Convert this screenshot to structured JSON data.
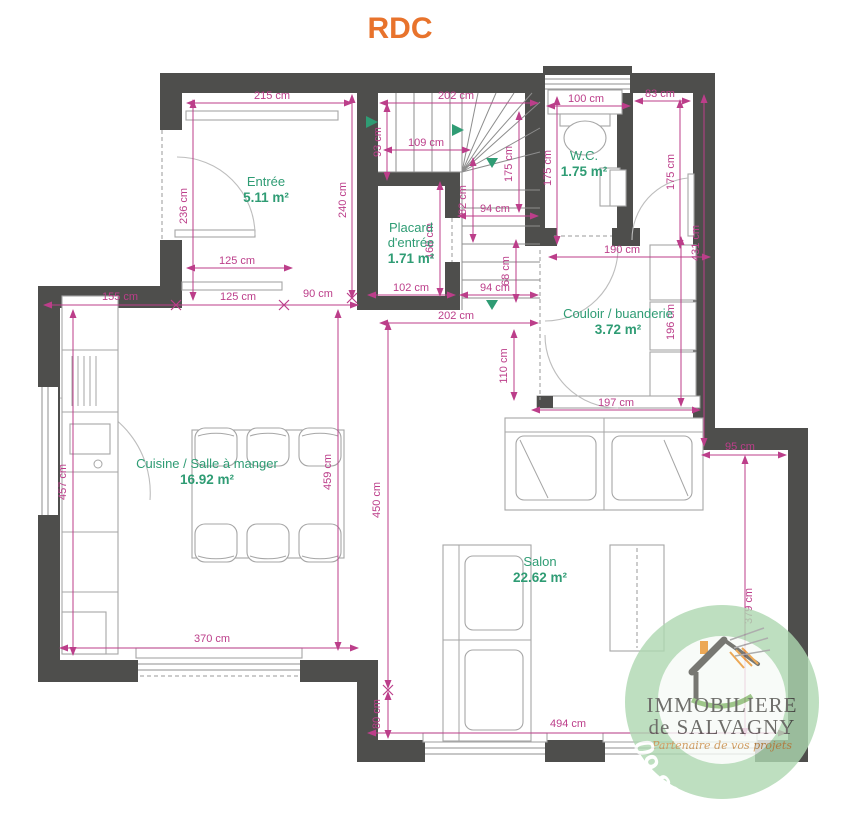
{
  "title": "RDC",
  "colors": {
    "wall": "#4e4e4c",
    "dimension": "#bc3e8a",
    "room_label": "#2f9c74",
    "title": "#e8732c",
    "furniture": "#a6a6a6",
    "wm_green": "#aed8b1"
  },
  "rooms": [
    {
      "lines": [
        "Entrée"
      ],
      "area": "5.11 m²",
      "x": 266,
      "y": 186
    },
    {
      "lines": [
        "Placard",
        "d'entrée"
      ],
      "area": "1.71 m²",
      "x": 411,
      "y": 232
    },
    {
      "lines": [
        "W.C."
      ],
      "area": "1.75 m²",
      "x": 584,
      "y": 160
    },
    {
      "lines": [
        "Couloir / buanderie"
      ],
      "area": "3.72 m²",
      "x": 618,
      "y": 318
    },
    {
      "lines": [
        "Cuisine / Salle à manger"
      ],
      "area": "16.92 m²",
      "x": 207,
      "y": 468
    },
    {
      "lines": [
        "Salon"
      ],
      "area": "22.62 m²",
      "x": 540,
      "y": 566
    }
  ],
  "dimensions": [
    {
      "label": "215 cm",
      "x": 272,
      "y": 99,
      "rot": 0
    },
    {
      "label": "202 cm",
      "x": 456,
      "y": 99,
      "rot": 0
    },
    {
      "label": "100 cm",
      "x": 586,
      "y": 102,
      "rot": 0
    },
    {
      "label": "83 cm",
      "x": 660,
      "y": 97,
      "rot": 0
    },
    {
      "label": "236 cm",
      "x": 187,
      "y": 206,
      "rot": -90
    },
    {
      "label": "240 cm",
      "x": 346,
      "y": 200,
      "rot": -90
    },
    {
      "label": "93 cm",
      "x": 381,
      "y": 142,
      "rot": -90
    },
    {
      "label": "109 cm",
      "x": 426,
      "y": 146,
      "rot": 0
    },
    {
      "label": "175 cm",
      "x": 551,
      "y": 168,
      "rot": -90
    },
    {
      "label": "175 cm",
      "x": 674,
      "y": 172,
      "rot": -90
    },
    {
      "label": "175 cm",
      "x": 512,
      "y": 164,
      "rot": -90
    },
    {
      "label": "82 cm",
      "x": 466,
      "y": 200,
      "rot": -90
    },
    {
      "label": "94 cm",
      "x": 495,
      "y": 212,
      "rot": 0
    },
    {
      "label": "68 cm",
      "x": 509,
      "y": 271,
      "rot": -90
    },
    {
      "label": "94 cm",
      "x": 495,
      "y": 291,
      "rot": 0
    },
    {
      "label": "102 cm",
      "x": 411,
      "y": 291,
      "rot": 0
    },
    {
      "label": "168 cm",
      "x": 433,
      "y": 241,
      "rot": -90
    },
    {
      "label": "190 cm",
      "x": 622,
      "y": 253,
      "rot": 0
    },
    {
      "label": "431 cm",
      "x": 699,
      "y": 243,
      "rot": -90
    },
    {
      "label": "202 cm",
      "x": 456,
      "y": 319,
      "rot": 0
    },
    {
      "label": "110 cm",
      "x": 507,
      "y": 366,
      "rot": -90
    },
    {
      "label": "196 cm",
      "x": 674,
      "y": 322,
      "rot": -90
    },
    {
      "label": "197 cm",
      "x": 616,
      "y": 406,
      "rot": 0
    },
    {
      "label": "95 cm",
      "x": 740,
      "y": 450,
      "rot": 0
    },
    {
      "label": "155 cm",
      "x": 120,
      "y": 300,
      "rot": 0
    },
    {
      "label": "125 cm",
      "x": 238,
      "y": 300,
      "rot": 0
    },
    {
      "label": "90 cm",
      "x": 318,
      "y": 297,
      "rot": 0
    },
    {
      "label": "125 cm",
      "x": 237,
      "y": 264,
      "rot": 0
    },
    {
      "label": "459 cm",
      "x": 331,
      "y": 472,
      "rot": -90
    },
    {
      "label": "457 cm",
      "x": 66,
      "y": 482,
      "rot": -90
    },
    {
      "label": "450 cm",
      "x": 380,
      "y": 500,
      "rot": -90
    },
    {
      "label": "370 cm",
      "x": 212,
      "y": 642,
      "rot": 0
    },
    {
      "label": "80 cm",
      "x": 380,
      "y": 714,
      "rot": -90
    },
    {
      "label": "494 cm",
      "x": 568,
      "y": 727,
      "rot": 0
    },
    {
      "label": "379 cm",
      "x": 752,
      "y": 606,
      "rot": -90
    }
  ],
  "watermark": {
    "line1": "IMMOBILIERE",
    "line2": "de SALVAGNY",
    "tagline": "Partenaire de vos projets",
    "phone": "09 83 557 559"
  }
}
